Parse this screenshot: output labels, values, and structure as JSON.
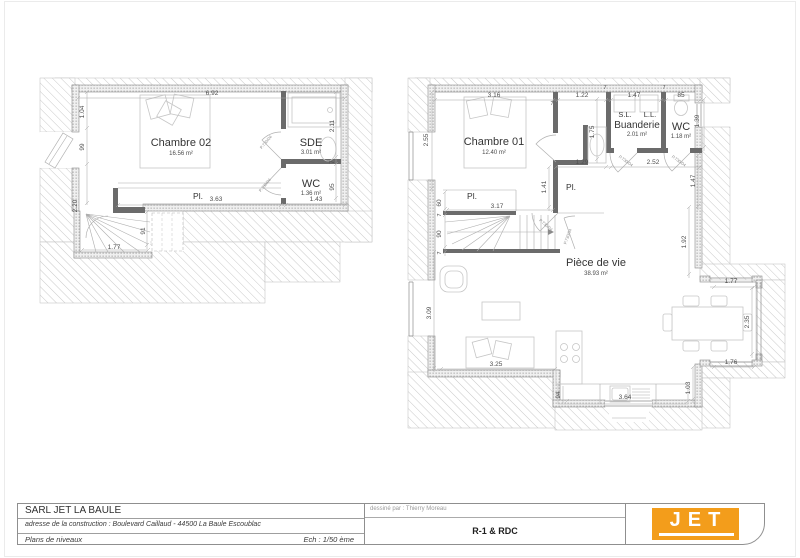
{
  "title_block": {
    "company": "SARL JET LA BAULE",
    "address": "adresse de la construction  :  Boulevard Caillaud - 44500 La Baule Escoublac",
    "doc_title": "Plans de niveaux",
    "scale": "Ech : 1/50 ème",
    "drawn_by": "dessiné par : Thierry Moreau",
    "sheet_name": "R-1 & RDC",
    "logo_text": "JET",
    "logo_color": "#F39D1B"
  },
  "door_tag": "P.730/04",
  "r1": {
    "chambre02": "Chambre 02",
    "chambre02_area": "16.56 m²",
    "sde": "SDE",
    "sde_area": "3.01 m²",
    "wc": "WC",
    "wc_area": "1.36 m²",
    "pl": "Pl.",
    "d_top": "6.92",
    "d_l1": "1.04",
    "d_l2": "99",
    "d_l3": "2.20",
    "d_r1": "2.11",
    "d_r2": "7",
    "d_r3": "95",
    "d_b1": "3.63",
    "d_b2": "1.43",
    "d_s1": "1.77",
    "d_s2": "91"
  },
  "rdc": {
    "chambre01": "Chambre 01",
    "chambre01_area": "12.40 m²",
    "sl": "S.L.",
    "ll": "L.L.",
    "buanderie": "Buanderie",
    "buanderie_area": "2.01 m²",
    "wc": "WC",
    "wc_area": "1.18 m²",
    "piece": "Pièce de vie",
    "piece_area": "38.93 m²",
    "pl1": "Pl.",
    "pl2": "Pl.",
    "seven": "7",
    "d_t1": "3.16",
    "d_t2": "1.22",
    "d_t3": "1.47",
    "d_t4": "85",
    "d_l1": "2.55",
    "d_l2": "60",
    "d_l3": "90",
    "d_l4": "3.09",
    "d_h1": "1.75",
    "d_h2": "1.29",
    "d_h3": "2.52",
    "d_h4": "1.41",
    "d_h5": "1.47",
    "d_h6": "1.39",
    "d_st": "3.17",
    "d_r1": "1.92",
    "d_r2": "1.77",
    "d_r3": "2.35",
    "d_r4": "1.76",
    "d_b1": "3.25",
    "d_b2": "94",
    "d_b3": "3.64",
    "d_b4": "1.03"
  }
}
